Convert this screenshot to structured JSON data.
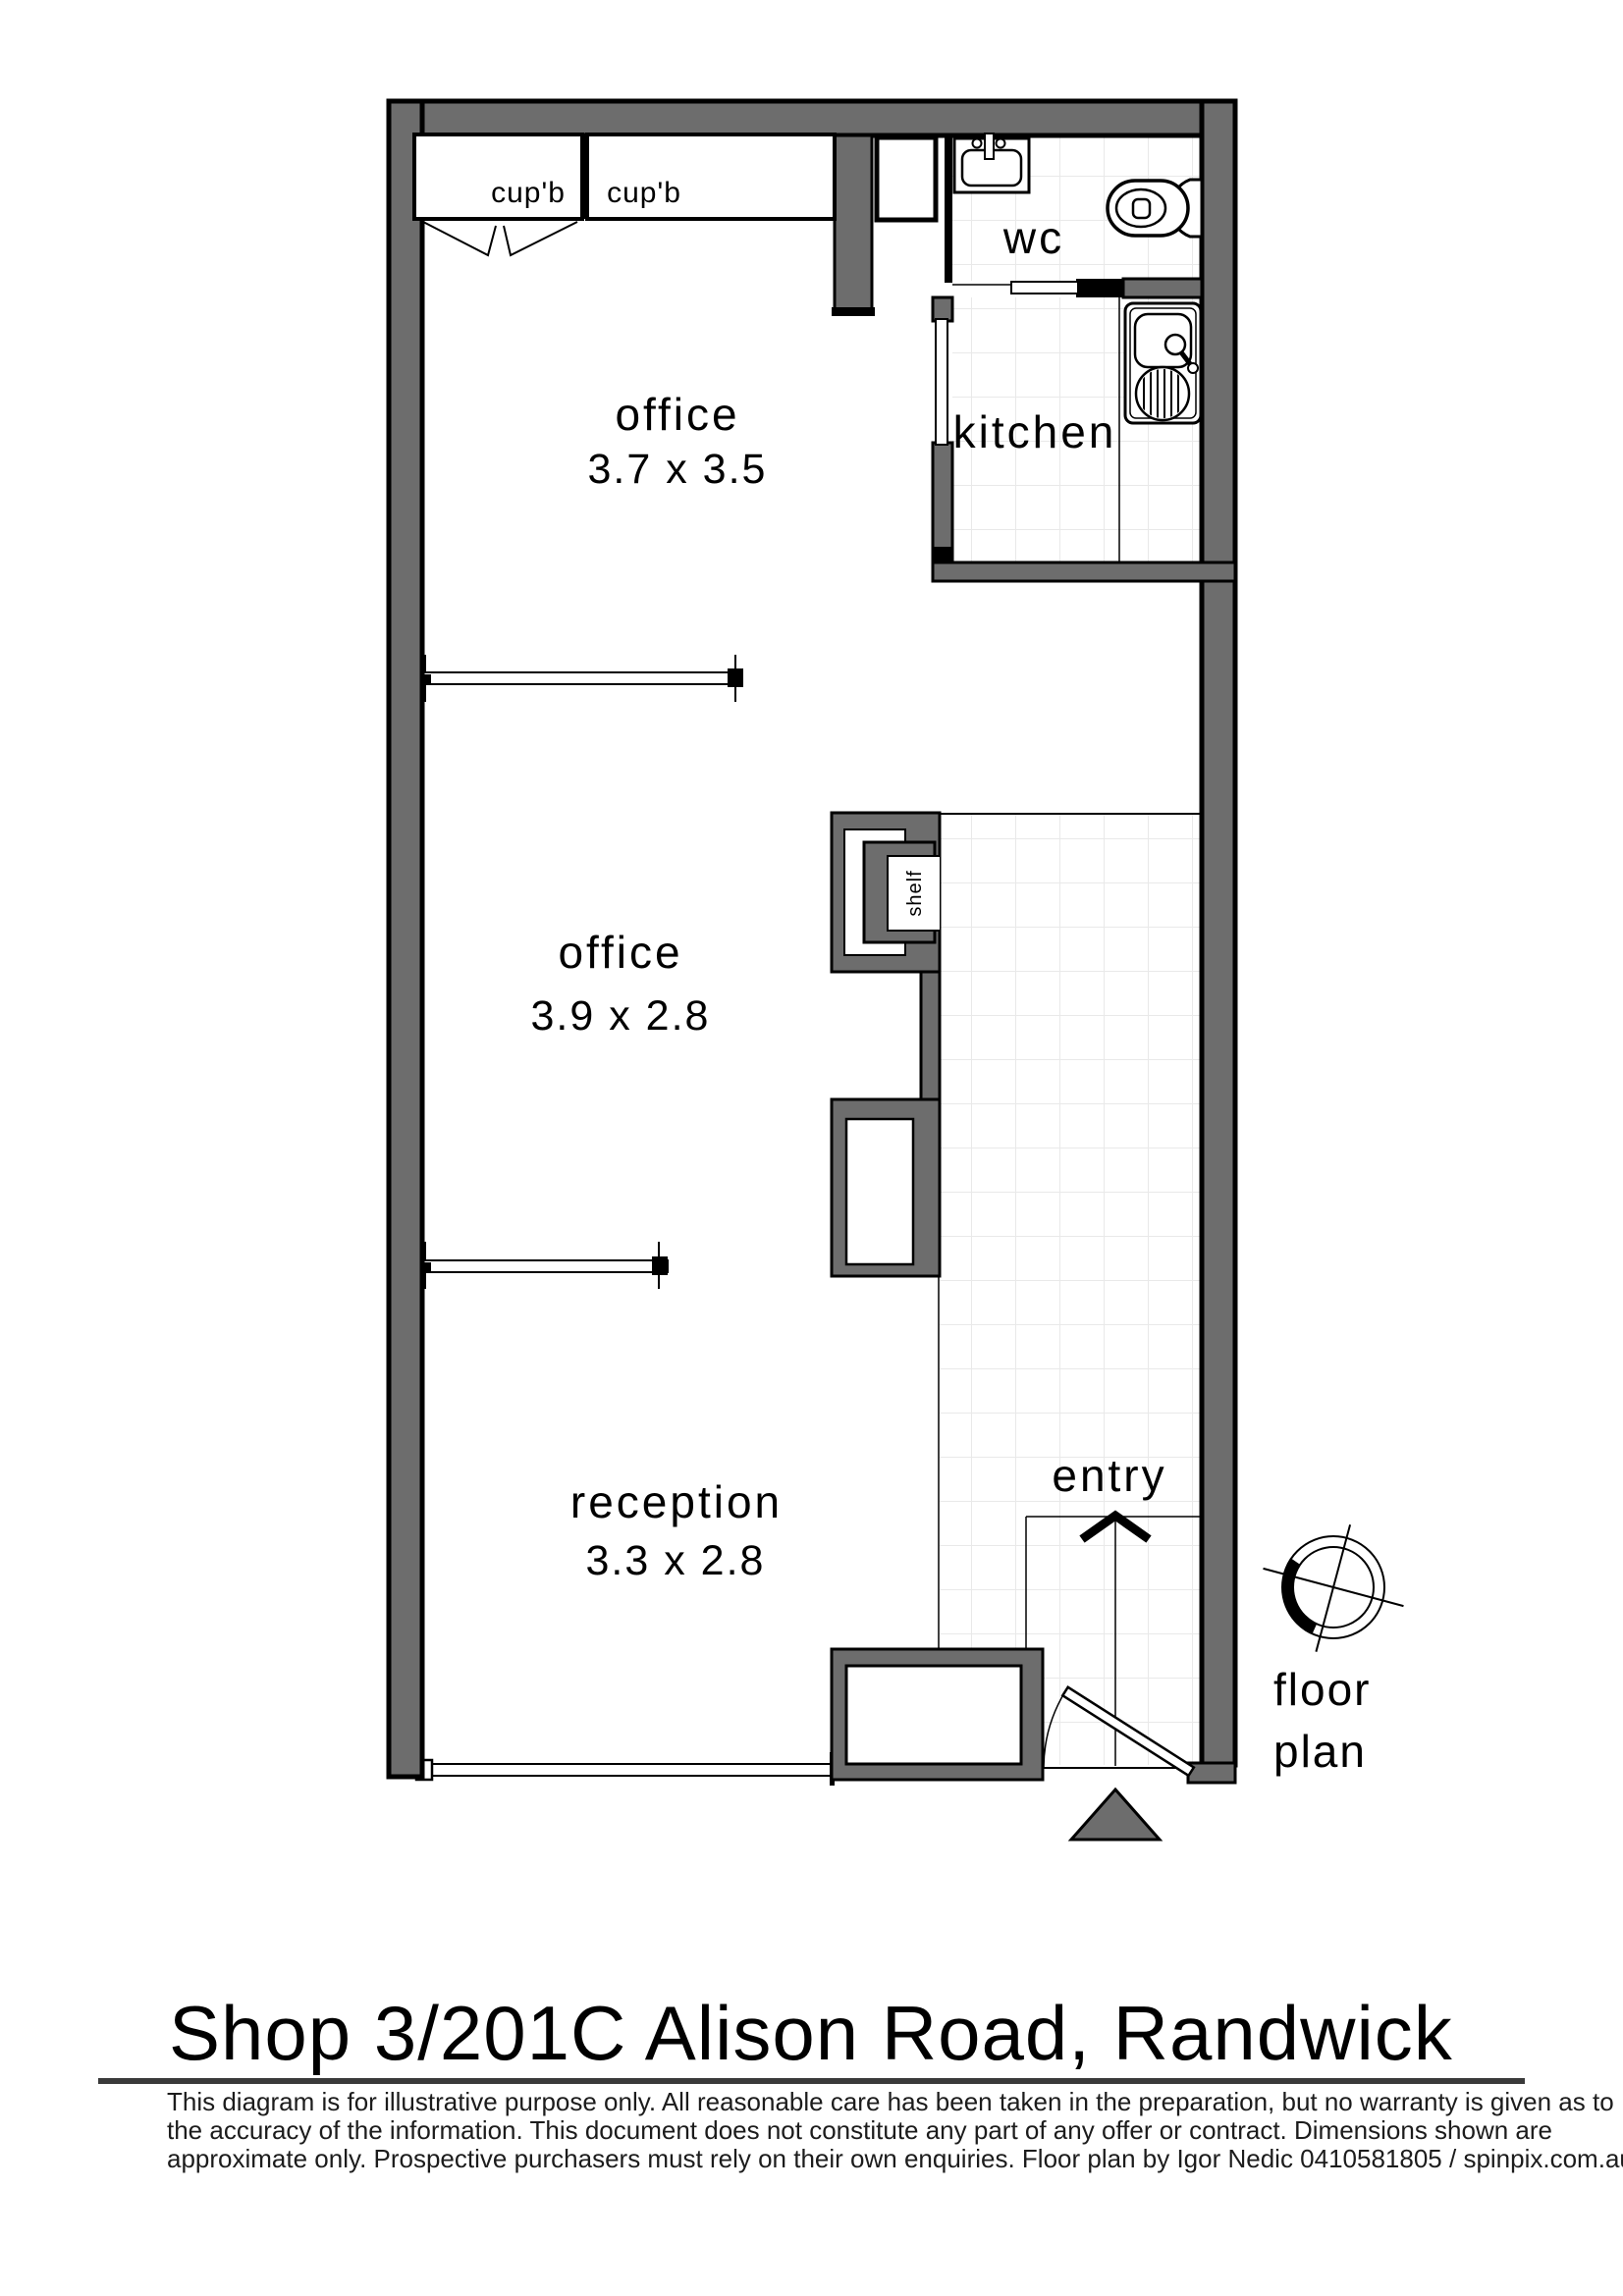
{
  "plan": {
    "rooms": [
      {
        "id": "office-1",
        "label": "office",
        "dims": "3.7 x 3.5"
      },
      {
        "id": "office-2",
        "label": "office",
        "dims": "3.9 x 2.8"
      },
      {
        "id": "reception",
        "label": "reception",
        "dims": "3.3 x 2.8"
      },
      {
        "id": "kitchen",
        "label": "kitchen"
      },
      {
        "id": "wc",
        "label": "wc"
      },
      {
        "id": "entry",
        "label": "entry"
      }
    ],
    "fixtures": {
      "cupboard_left": "cup'b",
      "cupboard_right": "cup'b",
      "shelf": "shelf"
    },
    "caption": {
      "line1": "floor",
      "line2": "plan"
    }
  },
  "footer": {
    "title": "Shop 3/201C Alison Road, Randwick",
    "disclaimer": [
      "This diagram is for illustrative purpose only. All reasonable care has been taken in the preparation, but no warranty is given as to",
      "the accuracy of the information. This document does not constitute any part of any offer or contract. Dimensions shown are",
      "approximate only. Prospective purchasers must rely on their own enquiries. Floor plan by Igor Nedic 0410581805 / spinpix.com.au"
    ]
  },
  "icons": [
    "compass-icon",
    "toilet-icon",
    "basin-icon",
    "kitchen-sink-icon",
    "entry-arrow-icon",
    "entry-triangle-icon"
  ],
  "colors": {
    "wall": "#6d6d6d",
    "outline": "#000000",
    "tile_line": "#e9e9e9",
    "rule": "#3a3a3a",
    "background": "#ffffff"
  }
}
